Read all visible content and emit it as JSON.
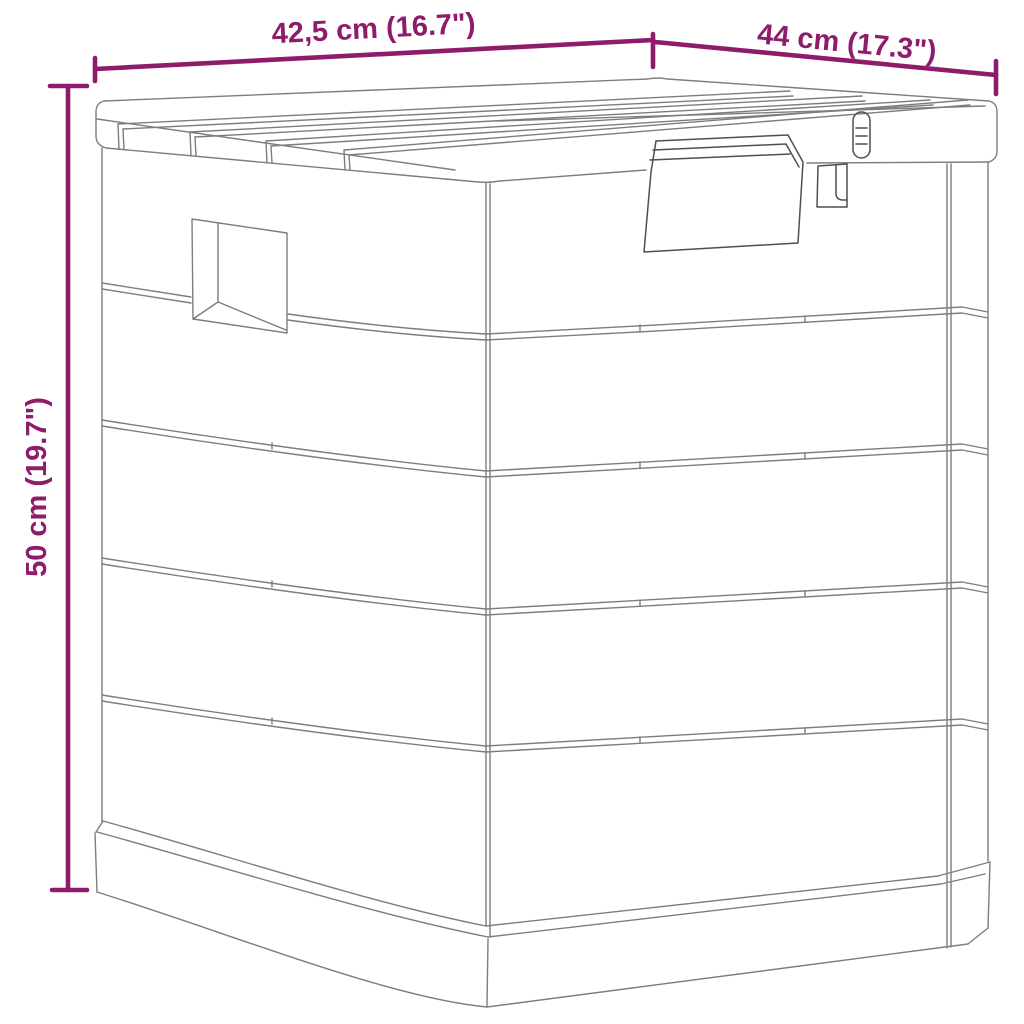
{
  "page": {
    "background": "#ffffff"
  },
  "colors": {
    "dimension": "#8e1c6b",
    "line": "#7d7d7d",
    "line_dark": "#4f4f4f"
  },
  "dimensions": {
    "front_width": {
      "label": "42,5 cm (16.7\")"
    },
    "side_depth": {
      "label": "44 cm (17.3\")"
    },
    "height": {
      "label": "50 cm (19.7\")"
    }
  }
}
